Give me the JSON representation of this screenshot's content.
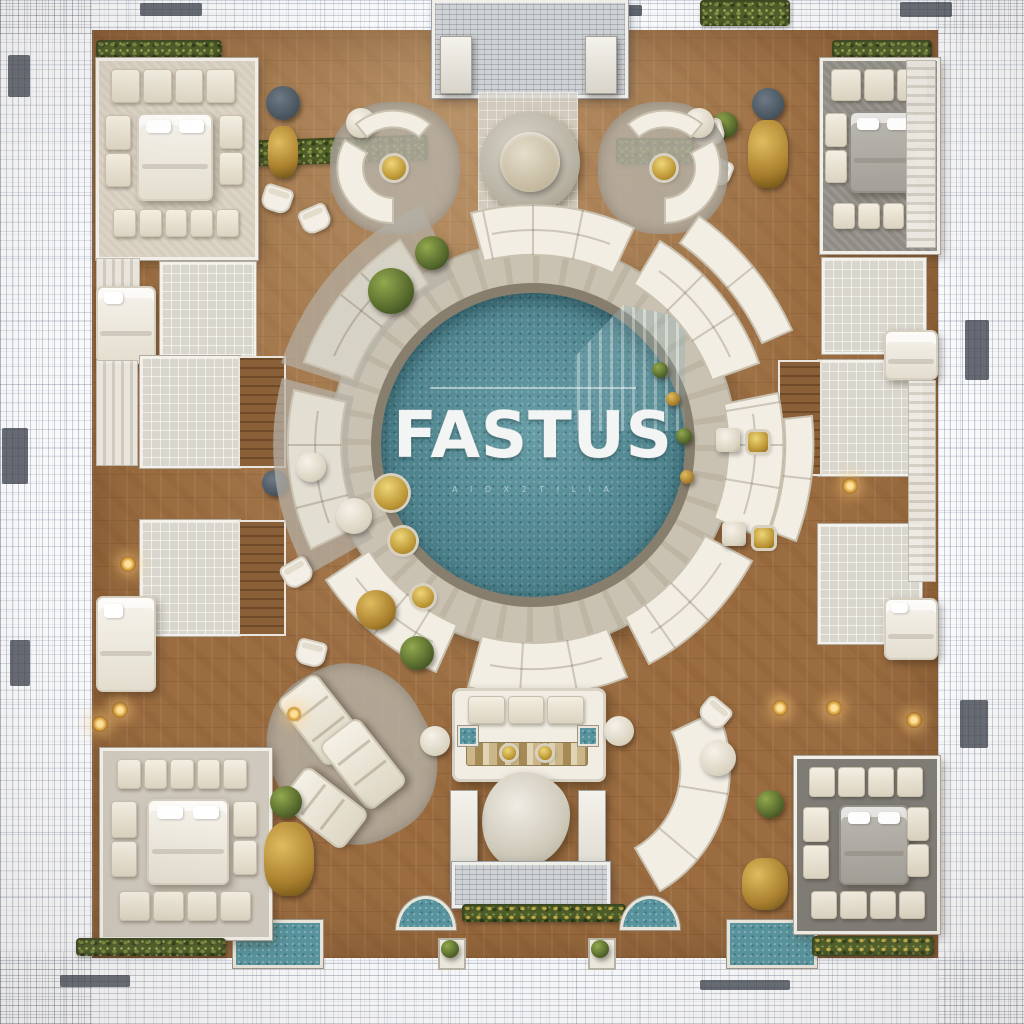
{
  "scene": {
    "kind": "architectural-floor-plan-render",
    "view": "top-down",
    "style": "photorealistic center fading to blueprint sketch at edges"
  },
  "pool": {
    "title": "FASTUS",
    "tagline": "A I D X 2 T I L I A",
    "water_color": "#56929c",
    "rim_color": "#877e6e",
    "feature": "glass-tower-reflection"
  },
  "palette": {
    "paper": "#f8f9fb",
    "sketch_line": "#37414f",
    "wood": "#9a6c40",
    "walkway": "#c9c1b1",
    "carpet_beige": "#d6cdbe",
    "carpet_gray": "#8f8c85",
    "cushion": "#f1ebdf",
    "wall": "#f2efe8",
    "hedge_green": "#4f5e2a",
    "gold": "#bb9434",
    "spa_teal": "#57939d"
  },
  "furniture_glossary": [
    "mosaic-pool",
    "curved-sofa-ring",
    "stone-walkway-ring",
    "corner-bedroom-suite",
    "double-bed",
    "modular-cushion-sofa",
    "round-stone-table",
    "circular-seating-cluster",
    "chaise-lounge",
    "media-console-sofa-set",
    "organic-stone-table",
    "gold-drink-tray",
    "boxwood-shrub",
    "hedge-planter",
    "bathroom-tile-room",
    "wardrobe-closet",
    "entrance-portico",
    "spa-tile-pad"
  ]
}
